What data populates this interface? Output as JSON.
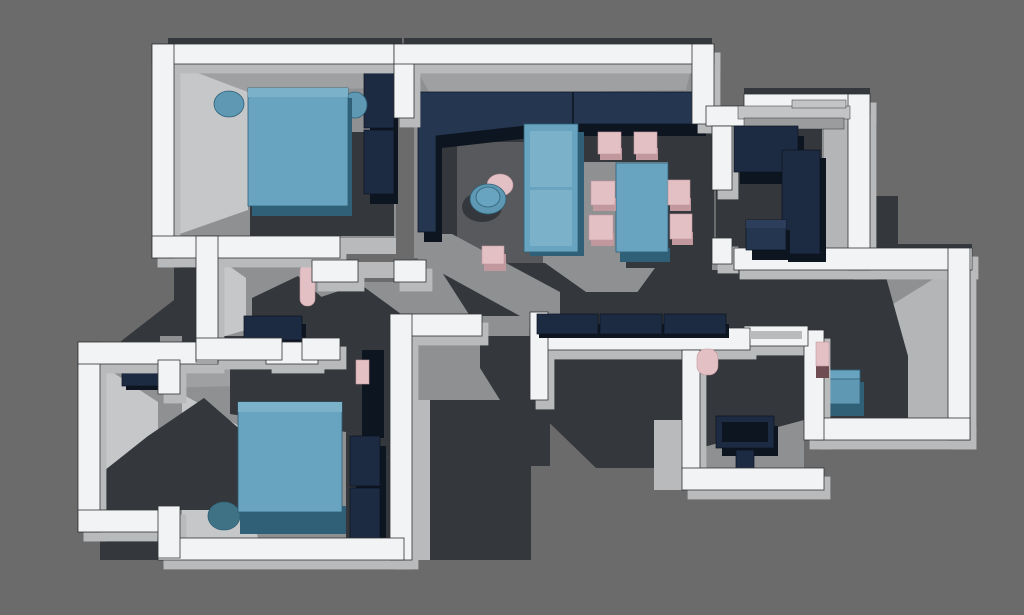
{
  "scene": {
    "description": "Top-down 3D axonometric render of an apartment floor plan with white extruded walls, gray floors and cast shadows, navy and teal furniture, and blush-pink accent pieces.",
    "style": "3d-floor-plan-render",
    "view": "top-down axonometric",
    "rooms": [
      {
        "id": "bedroom-1",
        "position": "top-left",
        "furniture": [
          "double-bed",
          "round-nightstand-left",
          "round-nightstand-right",
          "wardrobe"
        ]
      },
      {
        "id": "living-dining-area",
        "position": "center",
        "furniture": [
          "corner-sofa",
          "loveseat",
          "round-coffee-table",
          "round-side-table",
          "pouf",
          "rug",
          "dining-table",
          "dining-chair-x6"
        ]
      },
      {
        "id": "kitchen",
        "position": "right",
        "furniture": [
          "l-shaped-counter",
          "kitchen-island"
        ]
      },
      {
        "id": "bathroom-small",
        "position": "center-left",
        "furniture": [
          "wall-shelf",
          "toilet",
          "vanity-cabinet"
        ]
      },
      {
        "id": "walk-in-closet",
        "position": "bottom-left",
        "furniture": [
          "cabinet"
        ]
      },
      {
        "id": "bedroom-2",
        "position": "bottom-left",
        "furniture": [
          "double-bed",
          "round-nightstand",
          "wardrobe",
          "tall-cabinet",
          "pink-accent"
        ]
      },
      {
        "id": "hallway",
        "position": "center",
        "furniture": [
          "bench-3-seat"
        ]
      },
      {
        "id": "bathroom-main",
        "position": "bottom-center",
        "furniture": [
          "toilet",
          "bathtub",
          "cabinet"
        ]
      },
      {
        "id": "study",
        "position": "bottom-right",
        "furniture": [
          "desk",
          "chair"
        ]
      }
    ]
  },
  "colors": {
    "background": "#6b6b6b",
    "wall": "#f2f3f5",
    "wall_side": "#b9babc",
    "wall_face": "#9fa0a2",
    "wall_face_light": "#c6c7c9",
    "outline": "#2f3236",
    "floor": "#8e9092",
    "floor_light": "#b4b5b7",
    "rug": "#57595c",
    "shadow": "#34373b",
    "navy": "#243650",
    "navy_mid": "#1d2b42",
    "navy_dark": "#0d1520",
    "navy_light": "#2c3e5c",
    "teal": "#68a4bf",
    "teal_light": "#7bb1c9",
    "teal_mid": "#5e98b3",
    "teal_dark": "#2f6077",
    "teal_deep": "#3e7284",
    "pink": "#e3c0c4",
    "pink_mid": "#c2989f",
    "pink_dark": "#6e4c52",
    "counter": "#c3c4c6",
    "counter_mid": "#9b9c9e"
  }
}
